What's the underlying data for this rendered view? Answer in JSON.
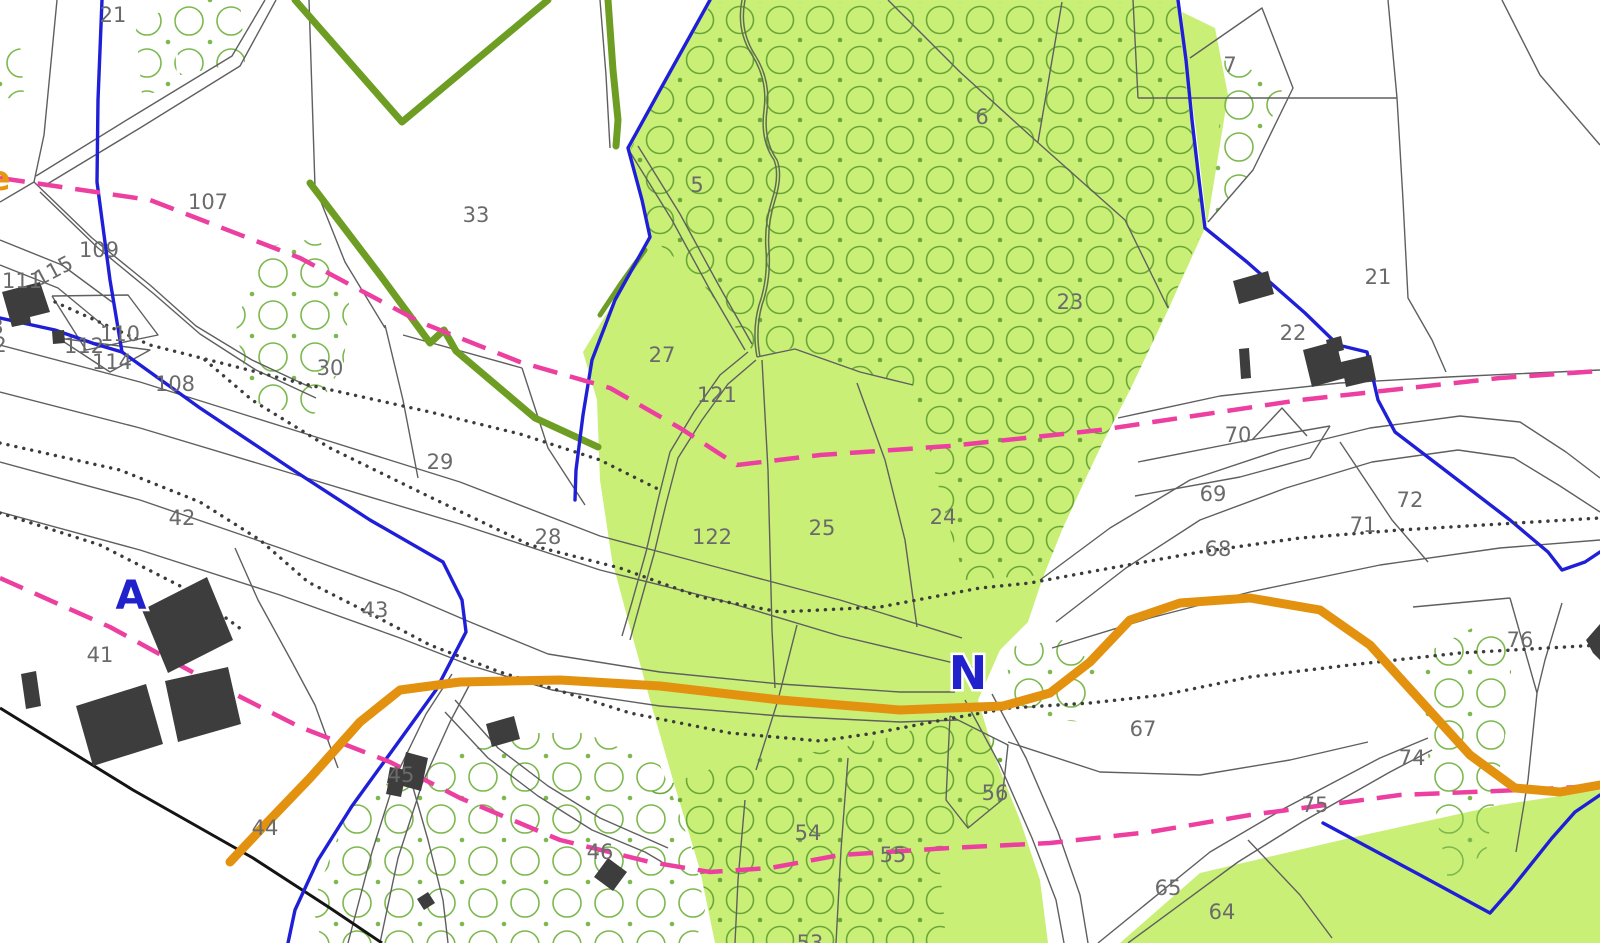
{
  "map": {
    "title": "cadastral-parcel-map",
    "letters": {
      "a": "A",
      "n": "N",
      "edge_partial": "e"
    },
    "colors": {
      "background": "#ffffff",
      "woodland_fill": "#c9ef77",
      "orchard_symbol_on_green": "#69a838",
      "orchard_symbol_on_white": "#7cb84e",
      "parcel_line": "#5f5f5f",
      "boundary_blue": "#1f1fd8",
      "boundary_pink_dashed": "#ec3fa0",
      "road_orange": "#e3920f",
      "hedge_olive": "#6d9d22",
      "stream_line": "#5f6e4f",
      "dotted_path": "#3c3c3c",
      "black_line": "#141414",
      "building_fill": "#3d3d3d",
      "label_gray": "#6a6a6a",
      "letter_blue": "#2222cc"
    },
    "parcel_labels": [
      {
        "label": "21",
        "x": 113,
        "y": 22
      },
      {
        "label": "107",
        "x": 208,
        "y": 209
      },
      {
        "label": "109",
        "x": 99,
        "y": 257
      },
      {
        "label": "111",
        "x": 22,
        "y": 288
      },
      {
        "label": "115",
        "x": 57,
        "y": 277,
        "rot": -28
      },
      {
        "label": "110",
        "x": 120,
        "y": 341
      },
      {
        "label": "112",
        "x": 84,
        "y": 353
      },
      {
        "label": "114",
        "x": 112,
        "y": 369,
        "size": 18
      },
      {
        "label": "108",
        "x": 175,
        "y": 391
      },
      {
        "label": "3",
        "x": -3,
        "y": 334,
        "size": 18
      },
      {
        "label": "2",
        "x": 0,
        "y": 352,
        "size": 18
      },
      {
        "label": "33",
        "x": 476,
        "y": 222
      },
      {
        "label": "30",
        "x": 330,
        "y": 375
      },
      {
        "label": "29",
        "x": 440,
        "y": 469
      },
      {
        "label": "28",
        "x": 548,
        "y": 544
      },
      {
        "label": "42",
        "x": 182,
        "y": 525
      },
      {
        "label": "43",
        "x": 375,
        "y": 617
      },
      {
        "label": "41",
        "x": 100,
        "y": 662
      },
      {
        "label": "44",
        "x": 265,
        "y": 835
      },
      {
        "label": "45",
        "x": 401,
        "y": 782,
        "size": 13
      },
      {
        "label": "46",
        "x": 600,
        "y": 859
      },
      {
        "label": "27",
        "x": 662,
        "y": 362
      },
      {
        "label": "121",
        "x": 717,
        "y": 402
      },
      {
        "label": "5",
        "x": 697,
        "y": 192
      },
      {
        "label": "6",
        "x": 982,
        "y": 124
      },
      {
        "label": "23",
        "x": 1070,
        "y": 309
      },
      {
        "label": "122",
        "x": 712,
        "y": 544
      },
      {
        "label": "25",
        "x": 822,
        "y": 535
      },
      {
        "label": "24",
        "x": 943,
        "y": 524
      },
      {
        "label": "7",
        "x": 1230,
        "y": 72
      },
      {
        "label": "21",
        "x": 1378,
        "y": 284
      },
      {
        "label": "22",
        "x": 1293,
        "y": 340
      },
      {
        "label": "70",
        "x": 1238,
        "y": 442
      },
      {
        "label": "69",
        "x": 1213,
        "y": 501
      },
      {
        "label": "68",
        "x": 1218,
        "y": 556
      },
      {
        "label": "71",
        "x": 1363,
        "y": 532
      },
      {
        "label": "72",
        "x": 1410,
        "y": 507
      },
      {
        "label": "76",
        "x": 1520,
        "y": 647
      },
      {
        "label": "67",
        "x": 1143,
        "y": 736
      },
      {
        "label": "74",
        "x": 1412,
        "y": 765
      },
      {
        "label": "75",
        "x": 1315,
        "y": 812
      },
      {
        "label": "56",
        "x": 995,
        "y": 800
      },
      {
        "label": "54",
        "x": 808,
        "y": 840
      },
      {
        "label": "55",
        "x": 893,
        "y": 862
      },
      {
        "label": "65",
        "x": 1168,
        "y": 895
      },
      {
        "label": "64",
        "x": 1222,
        "y": 919
      },
      {
        "label": "53",
        "x": 810,
        "y": 950
      }
    ]
  }
}
